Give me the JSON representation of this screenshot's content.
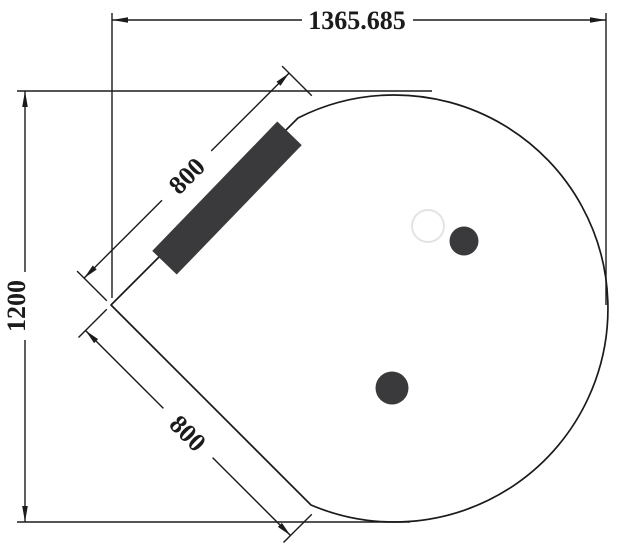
{
  "diagram": {
    "type": "cad-dimension-drawing",
    "colors": {
      "background": "#ffffff",
      "line": "#1b1b1b",
      "panel_fill": "#3a3a3c",
      "hole_fill": "#3a3a3c",
      "ghost_hole_stroke": "#e3e3e3",
      "shape_fill": "#ffffff"
    },
    "dimensions": {
      "overall_width": "1365.685",
      "overall_height": "1200",
      "upper_edge": "800",
      "lower_edge": "800"
    }
  }
}
